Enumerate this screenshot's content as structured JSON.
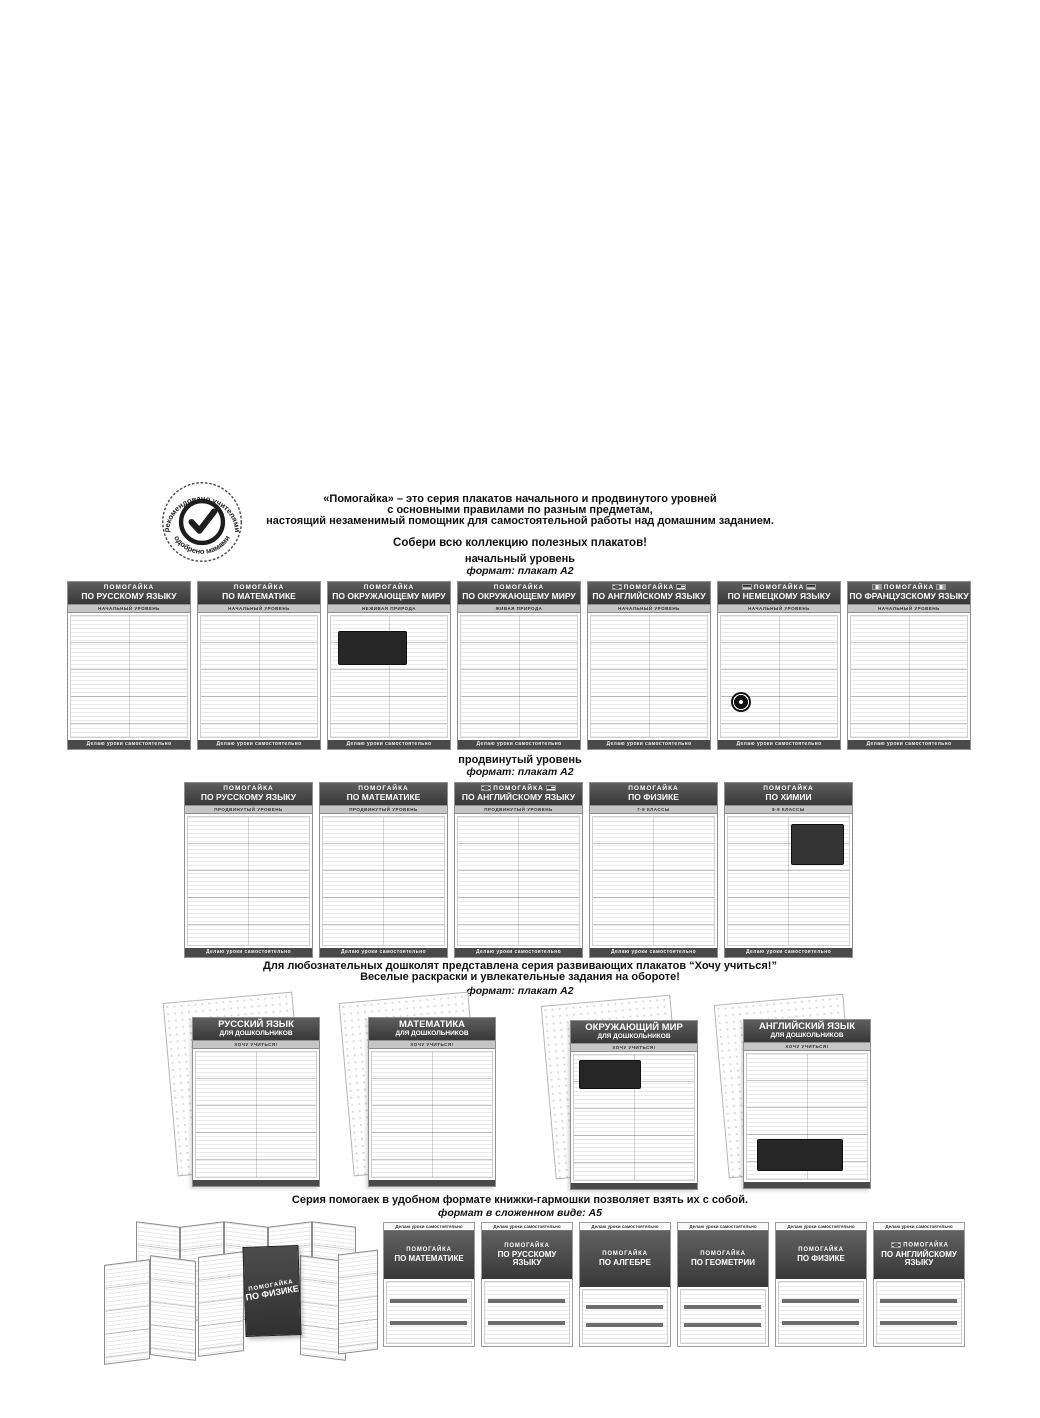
{
  "badge": {
    "top_text": "рекомендовано учителями",
    "bottom_text": "одобрено мамами"
  },
  "intro": {
    "brand": "«Помогайка»",
    "line1": "–  это серия плакатов начального и продвинутого уровней",
    "line2": "с основными правилами по разным предметам,",
    "line3": "настоящий незаменимый помощник для самостоятельной работы над домашним заданием.",
    "collect": "Собери всю коллекцию полезных плакатов!"
  },
  "common": {
    "brand": "ПОМОГАЙКА",
    "poster_footer": "Делаю уроки самостоятельно"
  },
  "beginner": {
    "level": "начальный уровень",
    "format": "формат: плакат А2",
    "posters": [
      {
        "title": "ПО РУССКОМУ ЯЗЫКУ",
        "subtitle": "НАЧАЛЬНЫЙ УРОВЕНЬ"
      },
      {
        "title": "ПО МАТЕМАТИКЕ",
        "subtitle": "НАЧАЛЬНЫЙ УРОВЕНЬ"
      },
      {
        "title": "ПО ОКРУЖАЮЩЕМУ МИРУ",
        "subtitle": "НЕЖИВАЯ ПРИРОДА"
      },
      {
        "title": "ПО ОКРУЖАЮЩЕМУ МИРУ",
        "subtitle": "ЖИВАЯ ПРИРОДА"
      },
      {
        "title": "ПО АНГЛИЙСКОМУ ЯЗЫКУ",
        "subtitle": "НАЧАЛЬНЫЙ УРОВЕНЬ"
      },
      {
        "title": "ПО НЕМЕЦКОМУ ЯЗЫКУ",
        "subtitle": "НАЧАЛЬНЫЙ УРОВЕНЬ"
      },
      {
        "title": "ПО ФРАНЦУЗСКОМУ ЯЗЫКУ",
        "subtitle": "НАЧАЛЬНЫЙ УРОВЕНЬ"
      }
    ]
  },
  "advanced": {
    "level": "продвинутый уровень",
    "format": "формат: плакат А2",
    "posters": [
      {
        "title": "ПО РУССКОМУ ЯЗЫКУ",
        "subtitle": "ПРОДВИНУТЫЙ УРОВЕНЬ"
      },
      {
        "title": "ПО МАТЕМАТИКЕ",
        "subtitle": "ПРОДВИНУТЫЙ УРОВЕНЬ"
      },
      {
        "title": "ПО АНГЛИЙСКОМУ ЯЗЫКУ",
        "subtitle": "ПРОДВИНУТЫЙ УРОВЕНЬ"
      },
      {
        "title": "ПО ФИЗИКЕ",
        "subtitle": "7-9 КЛАССЫ"
      },
      {
        "title": "ПО ХИМИИ",
        "subtitle": "8-9 КЛАССЫ"
      }
    ]
  },
  "preschool": {
    "line1": "Для любознательных дошколят представлена серия развивающих плакатов “Хочу учиться!”",
    "line2": "Веселые раскраски и увлекательные задания на обороте!",
    "format": "формат: плакат А2",
    "series_band": "ХОЧУ УЧИТЬСЯ!",
    "posters": [
      {
        "title": "РУССКИЙ ЯЗЫК",
        "subtitle": "ДЛЯ ДОШКОЛЬНИКОВ"
      },
      {
        "title": "МАТЕМАТИКА",
        "subtitle": "ДЛЯ ДОШКОЛЬНИКОВ"
      },
      {
        "title": "ОКРУЖАЮЩИЙ МИР",
        "subtitle": "ДЛЯ ДОШКОЛЬНИКОВ"
      },
      {
        "title": "АНГЛИЙСКИЙ ЯЗЫК",
        "subtitle": "ДЛЯ ДОШКОЛЬНИКОВ"
      }
    ]
  },
  "accordion": {
    "line1_pre": "Серия помогаек в удобном формате ",
    "line1_bold": "книжки-гармошки",
    "line1_post": " позволяет взять их с собой.",
    "format": "формат в сложенном виде: А5",
    "foldout_title": "ПО ФИЗИКЕ",
    "booklets": [
      {
        "title": "ПО МАТЕМАТИКЕ"
      },
      {
        "title": "ПО РУССКОМУ ЯЗЫКУ"
      },
      {
        "title": "ПО АЛГЕБРЕ"
      },
      {
        "title": "ПО ГЕОМЕТРИИ"
      },
      {
        "title": "ПО ФИЗИКЕ"
      },
      {
        "title": "ПО АНГЛИЙСКОМУ ЯЗЫКУ"
      }
    ]
  },
  "colors": {
    "header_dark": "#454545",
    "band_light": "#c6c6c6",
    "footer_dark": "#4a4a4a",
    "page_bg": "#ffffff"
  }
}
